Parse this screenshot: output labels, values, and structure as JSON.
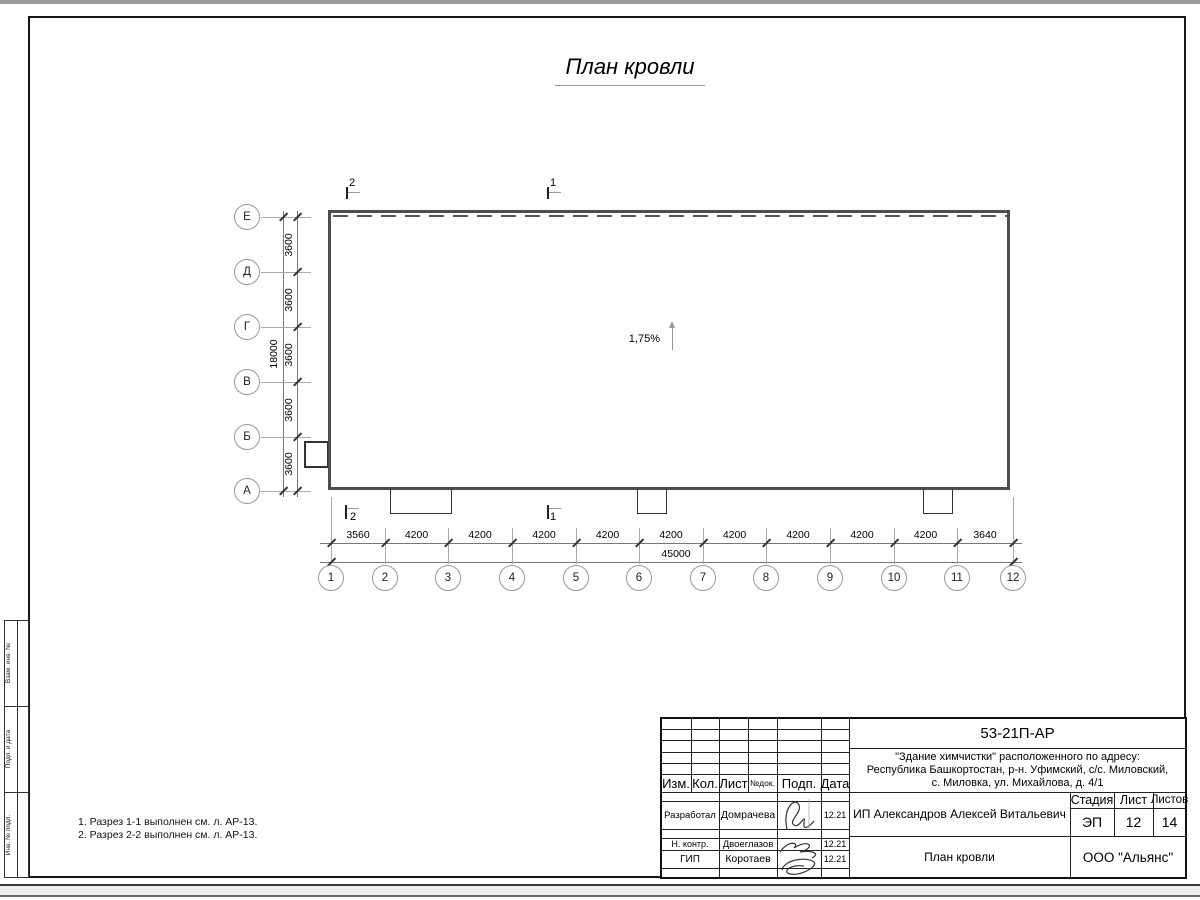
{
  "page": {
    "title": "План кровли"
  },
  "plan": {
    "slope_label": "1,75%",
    "section_marks": {
      "top_left": "2",
      "top_right": "1",
      "bottom_left": "2",
      "bottom_right": "1"
    }
  },
  "axes": {
    "columns": [
      "1",
      "2",
      "3",
      "4",
      "5",
      "6",
      "7",
      "8",
      "9",
      "10",
      "11",
      "12"
    ],
    "rows": [
      "Е",
      "Д",
      "Г",
      "В",
      "Б",
      "А"
    ],
    "col_dims": [
      "3560",
      "4200",
      "4200",
      "4200",
      "4200",
      "4200",
      "4200",
      "4200",
      "4200",
      "4200",
      "3640"
    ],
    "col_total": "45000",
    "row_dims": [
      "3600",
      "3600",
      "3600",
      "3600",
      "3600"
    ],
    "row_total": "18000"
  },
  "notes": {
    "line1": "1. Разрез 1-1 выполнен см. л. АР-13.",
    "line2": "2. Разрез 2-2 выполнен см. л. АР-13."
  },
  "side_stamp": {
    "box1": "Взам. инв. №",
    "box2": "Подп. и дата",
    "box3": "Инв. № подл."
  },
  "title_block": {
    "doc_number": "53-21П-АР",
    "project_line1": "\"Здание химчистки\" расположенного по адресу:",
    "project_line2": "Республика Башкортостан, р-н. Уфимский, с/с. Миловский,",
    "project_line3": "с. Миловка, ул. Михайлова, д. 4/1",
    "client": "ИП Александров Алексей Витальевич",
    "sheet_title": "План кровли",
    "company": "ООО \"Альянс\"",
    "cols": [
      "Изм.",
      "Кол.",
      "Лист",
      "№док.",
      "Подп.",
      "Дата"
    ],
    "stage_label": "Стадия",
    "sheet_label": "Лист",
    "sheets_label": "Листов",
    "stage": "ЭП",
    "sheet_num": "12",
    "sheets_total": "14",
    "roles": [
      {
        "role": "Разработал",
        "name": "Домрачева",
        "date": "12.21"
      },
      {
        "role": "Н. контр.",
        "name": "Двоеглазов",
        "date": "12.21"
      },
      {
        "role": "ГИП",
        "name": "Коротаев",
        "date": "12.21"
      }
    ]
  }
}
